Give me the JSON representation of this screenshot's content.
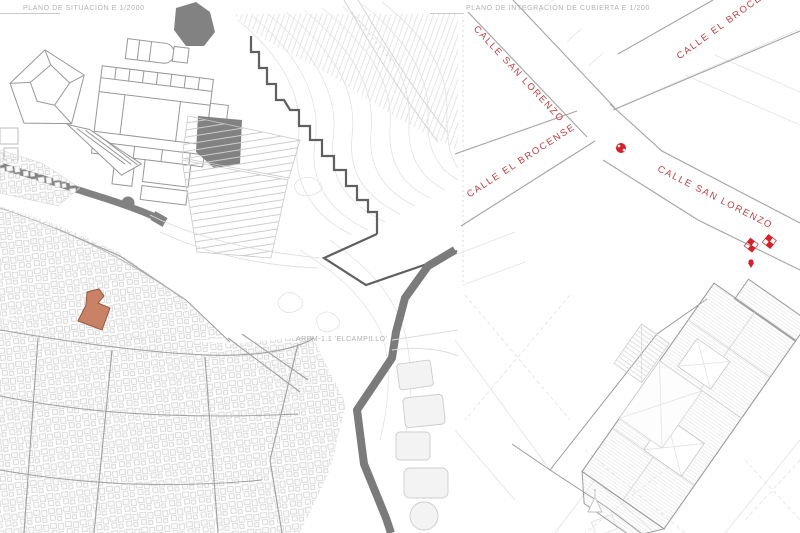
{
  "board": {
    "background": "#ffffff"
  },
  "left_panel": {
    "title": "PLANO DE SITUACIÓN E 1/2000",
    "area_label": "ARPM-1.1 'ELCAMPILLO'"
  },
  "right_panel": {
    "title": "PLANO DE INTEGRACIÓN DE CUBIERTA E 1/200",
    "street_labels": [
      "CALLE SAN LORENZO",
      "CALLE EL BROCENSE",
      "CALLE EL BROCENSE",
      "CALLE SAN LORENZO"
    ]
  },
  "colors": {
    "street_label_red": "#bf4043",
    "marker_red": "#d3222a",
    "highlight_fill": "#ca8267",
    "highlight_stroke": "#925a41",
    "title_gray": "#b2b2b2",
    "wall_dark_gray": "#7b7b7b",
    "solid_dark_gray": "#828282",
    "building_line_gray": "#989898",
    "contour_gray": "#e2e2e2"
  }
}
